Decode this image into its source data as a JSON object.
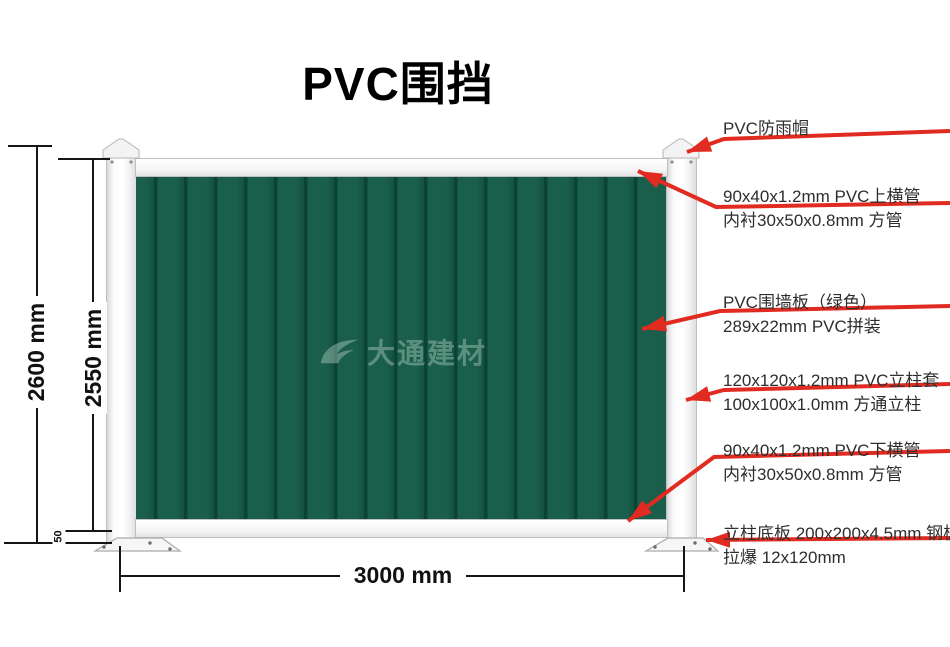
{
  "title": "PVC围挡",
  "watermark": {
    "brand": "大通建材"
  },
  "dimensions": {
    "total_height": "2600 mm",
    "panel_height": "2550 mm",
    "ground_clearance": "50",
    "width": "3000 mm"
  },
  "callouts": [
    {
      "id": "rain-cap",
      "lines": [
        "PVC防雨帽"
      ]
    },
    {
      "id": "top-rail",
      "lines": [
        "90x40x1.2mm PVC上横管",
        "内衬30x50x0.8mm 方管"
      ]
    },
    {
      "id": "wall-panel",
      "lines": [
        "PVC围墙板（绿色）",
        "289x22mm PVC拼装"
      ]
    },
    {
      "id": "post",
      "lines": [
        "120x120x1.2mm PVC立柱套",
        "100x100x1.0mm 方通立柱"
      ]
    },
    {
      "id": "bottom-rail",
      "lines": [
        "90x40x1.2mm PVC下横管",
        "内衬30x50x0.8mm 方管"
      ]
    },
    {
      "id": "base-plate",
      "lines": [
        "立柱底板 200x200x4.5mm 钢板",
        "拉爆 12x120mm"
      ]
    }
  ],
  "colors": {
    "panel_green": "#1a5f4c",
    "rib_dark": "#0b4334",
    "arrow_red": "#e12b20",
    "dimension_black": "#161616",
    "label_text": "#2e2e2e"
  }
}
